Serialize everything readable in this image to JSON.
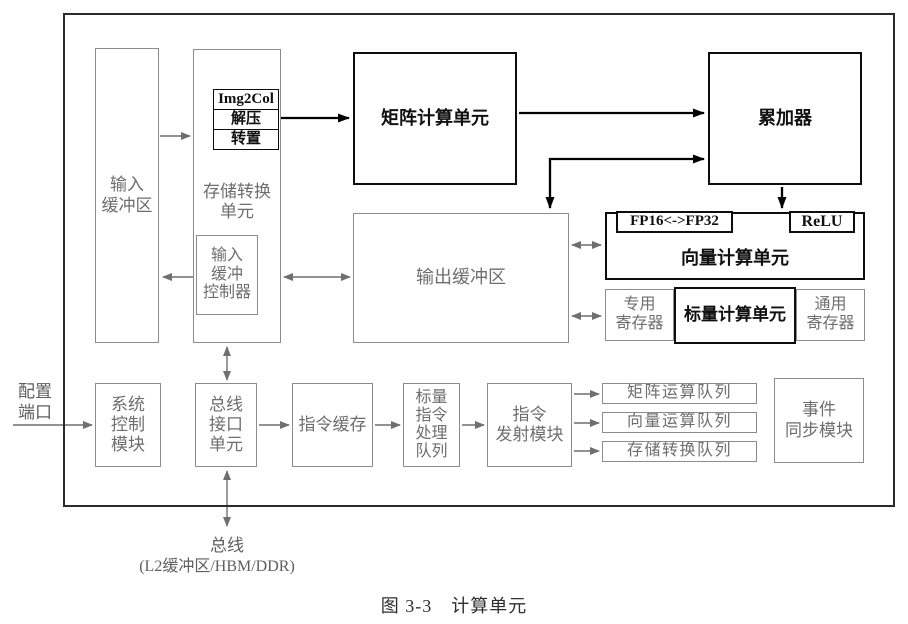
{
  "colors": {
    "outer_border": "#2b2b2b",
    "gray_border": "#8c8c8c",
    "gray_text": "#6e6e6e",
    "black": "#0d0d0d",
    "background": "#ffffff"
  },
  "blocks": {
    "input_buffer": {
      "label": "输入\n缓冲区"
    },
    "storage_conversion": {
      "label": "存储转换\n单元"
    },
    "img2col": {
      "label": "Img2Col"
    },
    "decompress": {
      "label": "解压"
    },
    "transpose": {
      "label": "转置"
    },
    "input_buffer_controller": {
      "label": "输入\n缓冲\n控制器"
    },
    "matrix_compute_unit": {
      "label": "矩阵计算单元"
    },
    "accumulator": {
      "label": "累加器"
    },
    "output_buffer": {
      "label": "输出缓冲区"
    },
    "fp16_fp32": {
      "label": "FP16<->FP32"
    },
    "relu": {
      "label": "ReLU"
    },
    "vector_compute_unit": {
      "label": "向量计算单元"
    },
    "special_registers": {
      "label": "专用\n寄存器"
    },
    "scalar_compute_unit": {
      "label": "标量计算单元"
    },
    "general_registers": {
      "label": "通用\n寄存器"
    },
    "system_control": {
      "label": "系统\n控制\n模块"
    },
    "bus_interface": {
      "label": "总线\n接口\n单元"
    },
    "instruction_cache": {
      "label": "指令缓存"
    },
    "scalar_instruction_queue": {
      "label": "标量\n指令\n处理\n队列"
    },
    "instruction_dispatch": {
      "label": "指令\n发射模块"
    },
    "matrix_op_queue": {
      "label": "矩阵运算队列"
    },
    "vector_op_queue": {
      "label": "向量运算队列"
    },
    "storage_conversion_queue": {
      "label": "存储转换队列"
    },
    "event_sync": {
      "label": "事件\n同步模块"
    }
  },
  "external": {
    "config_port": {
      "label": "配置\n端口"
    },
    "bus": {
      "label": "总线"
    },
    "bus_detail": {
      "label": "(L2缓冲区/HBM/DDR)"
    }
  },
  "caption": "图 3-3　计算单元"
}
